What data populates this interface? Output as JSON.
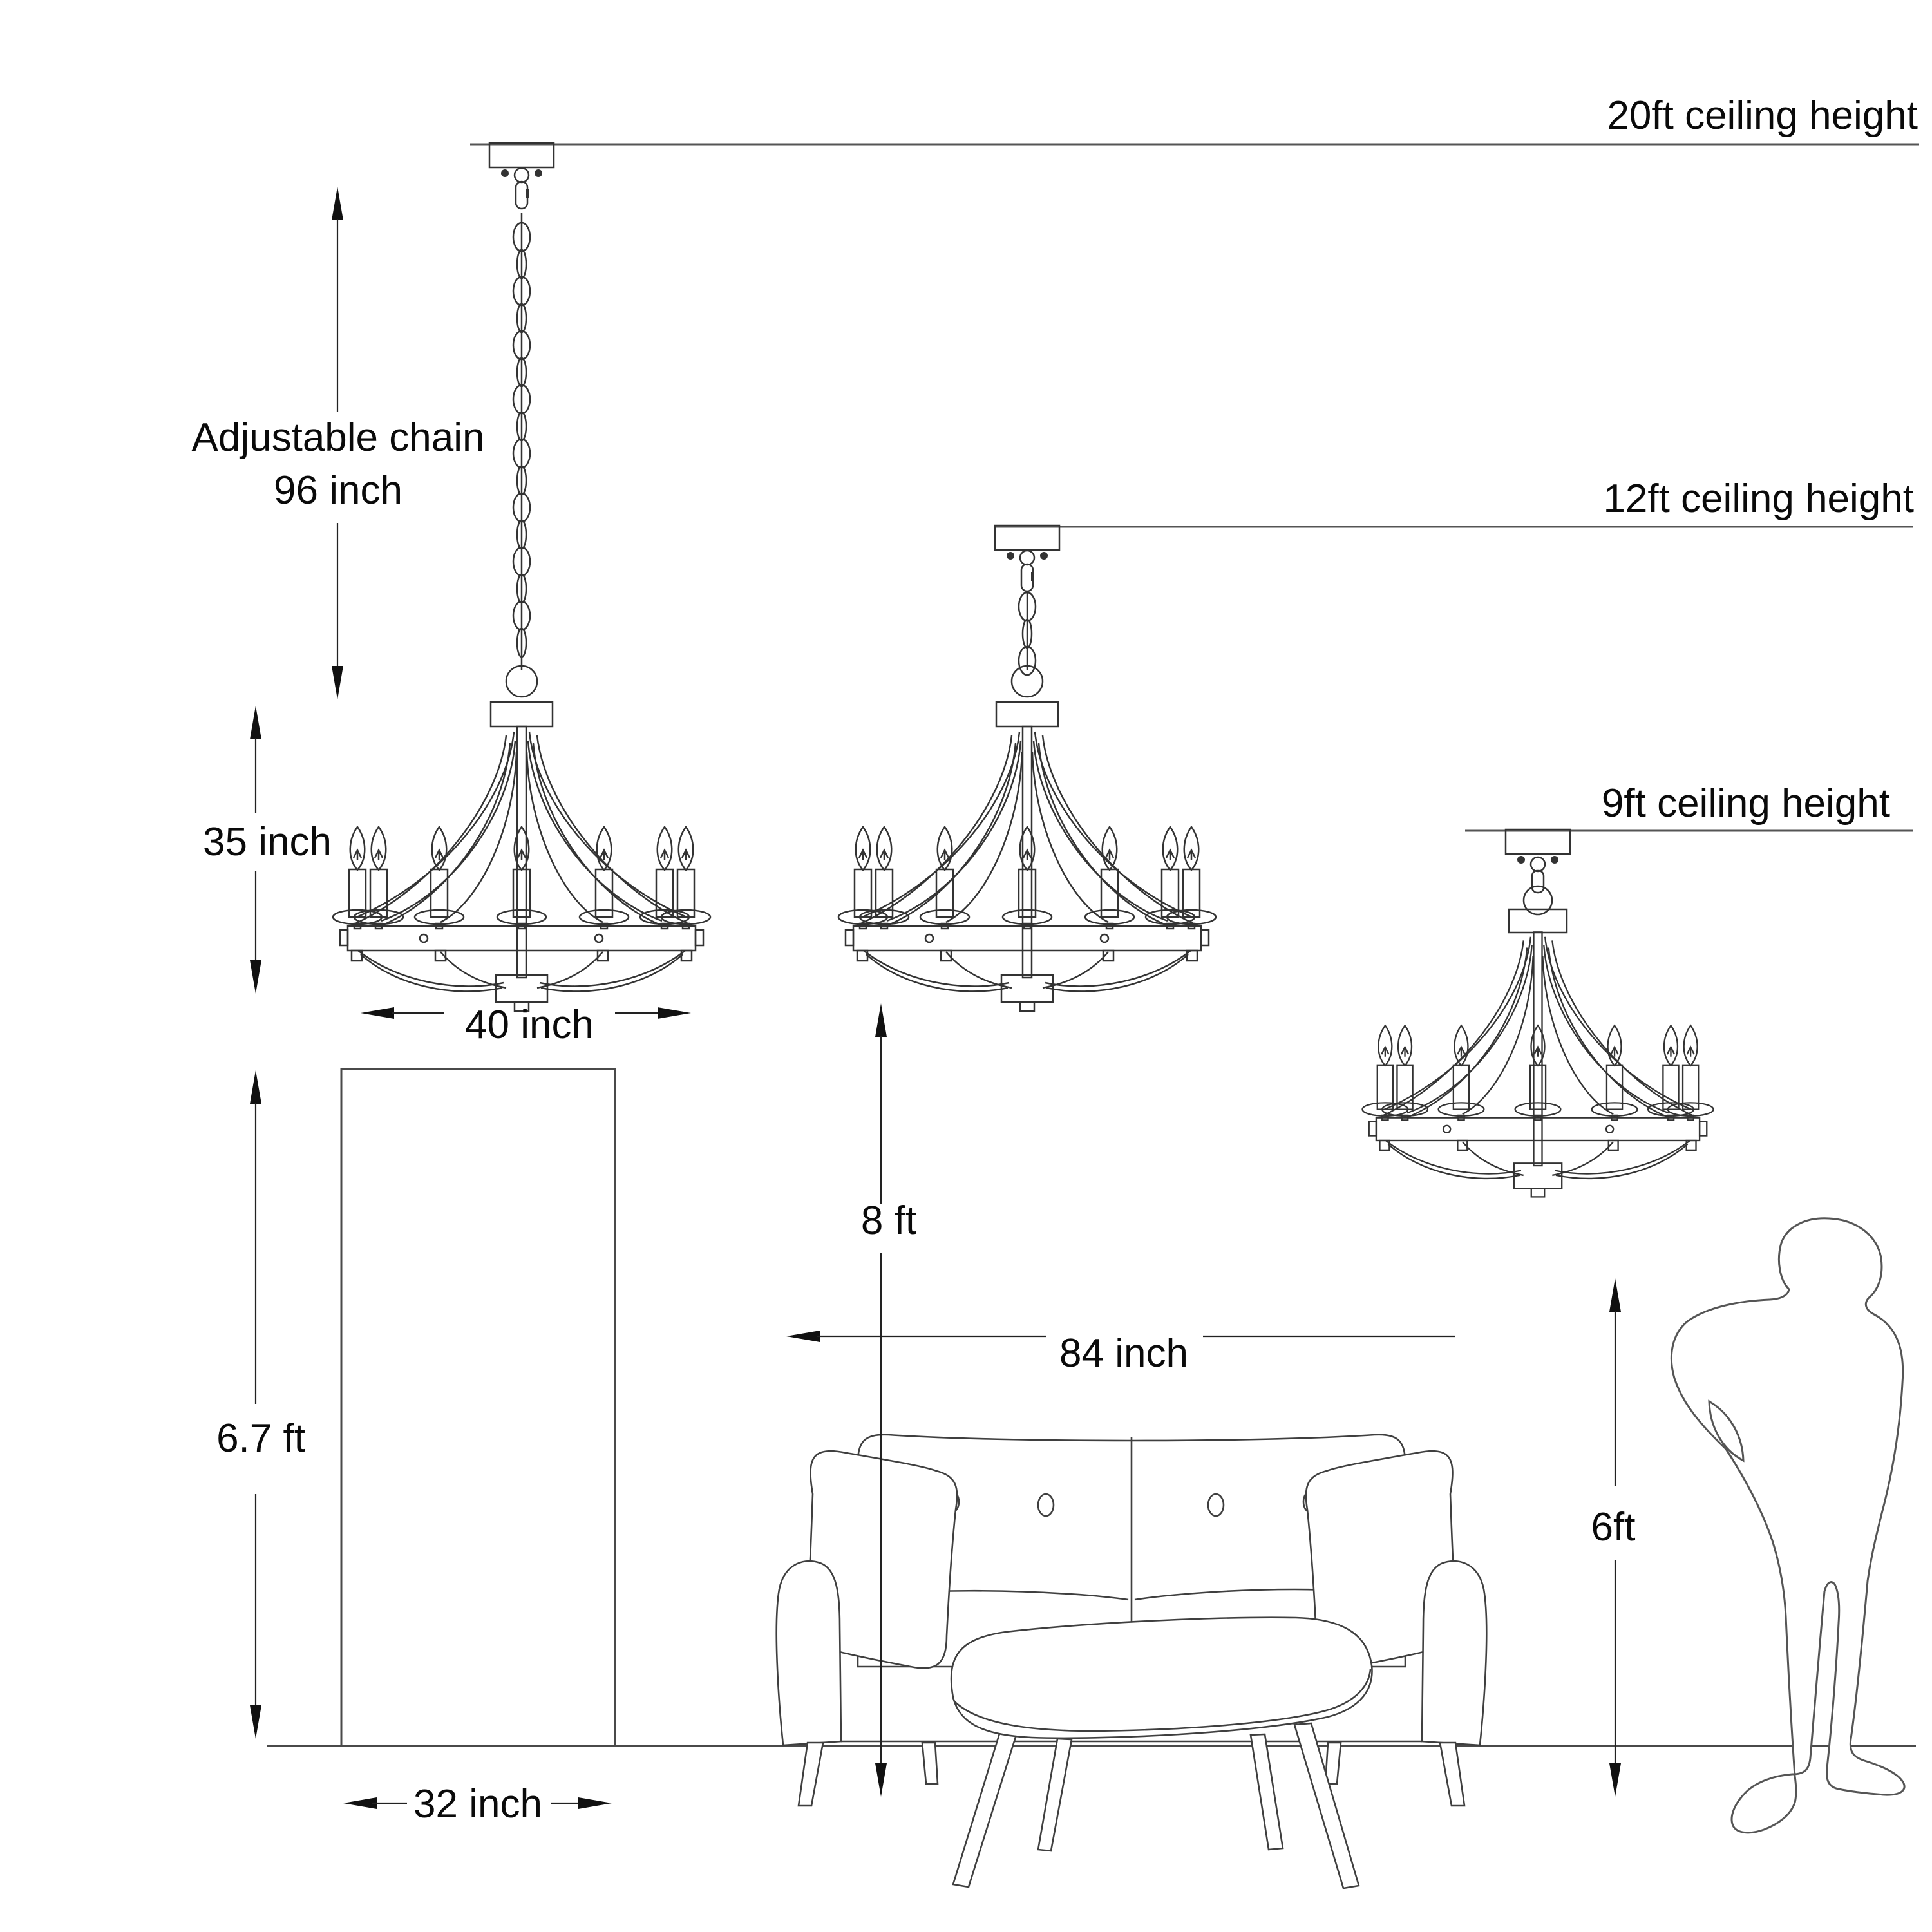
{
  "diagram_title": "Chandelier mounting height size guide",
  "colors": {
    "background": "#ffffff",
    "line": "#333333",
    "text": "#0a0a0a"
  },
  "ceilings": [
    {
      "label": "20ft ceiling height"
    },
    {
      "label": "12ft ceiling height"
    },
    {
      "label": "9ft ceiling height"
    }
  ],
  "dimensions": {
    "chain": {
      "line1": "Adjustable chain",
      "line2": "96 inch"
    },
    "fixture_height": "35 inch",
    "fixture_width": "40 inch",
    "door_height": "6.7 ft",
    "door_width": "32 inch",
    "hang_clearance": "8 ft",
    "sofa_width": "84 inch",
    "person_height": "6ft"
  }
}
